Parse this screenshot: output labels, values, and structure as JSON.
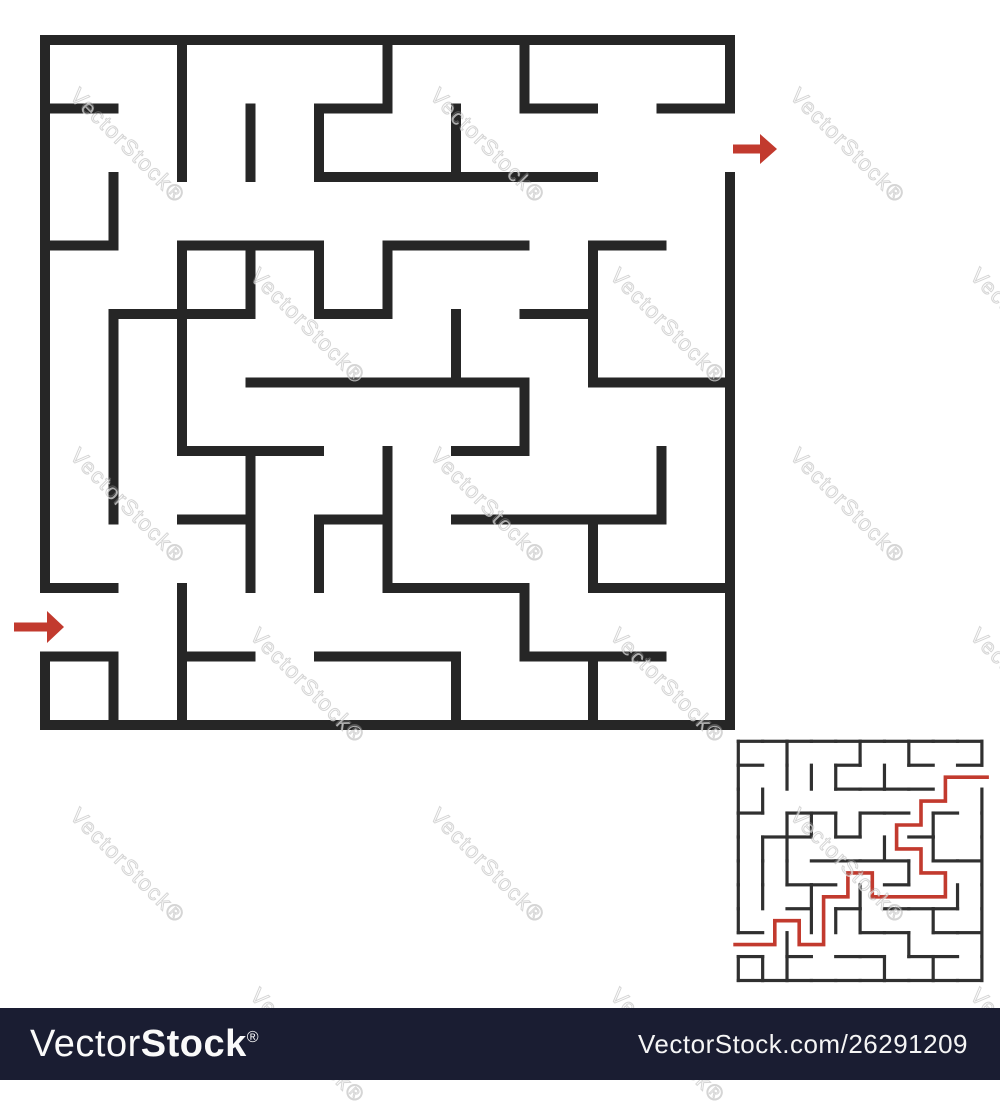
{
  "title": "Abstract square maze with entry and exit arrows and solution thumbnail",
  "watermark": {
    "text": "VectorStock",
    "reg_mark": "®",
    "angle_deg": 45,
    "anchors": [
      [
        83,
        83
      ],
      [
        443,
        83
      ],
      [
        803,
        83
      ],
      [
        263,
        263
      ],
      [
        623,
        263
      ],
      [
        983,
        263
      ],
      [
        83,
        443
      ],
      [
        443,
        443
      ],
      [
        803,
        443
      ],
      [
        263,
        623
      ],
      [
        623,
        623
      ],
      [
        983,
        623
      ],
      [
        83,
        803
      ],
      [
        443,
        803
      ],
      [
        803,
        803
      ],
      [
        263,
        983
      ],
      [
        623,
        983
      ],
      [
        983,
        983
      ]
    ]
  },
  "maze": {
    "rows": 10,
    "cols": 10,
    "wall_color_big": "#262626",
    "wall_color_small": "#303030",
    "accent_red": "#c23a2e",
    "big": {
      "x": 45,
      "y": 40,
      "cell": 68.5,
      "thickness": 10
    },
    "small": {
      "x": 738.3,
      "y": 741.3,
      "cell_w": 24.36,
      "cell_h": 23.92,
      "thickness": 3.2,
      "solution_width": 3.6
    },
    "h_walls": {
      "0": [
        0,
        1,
        2,
        3,
        4,
        5,
        6,
        7,
        8,
        9
      ],
      "1": [
        0,
        4,
        7,
        9
      ],
      "2": [
        4,
        5,
        6,
        7
      ],
      "3": [
        0,
        2,
        3,
        5,
        6,
        8
      ],
      "4": [
        1,
        2,
        4,
        7
      ],
      "5": [
        3,
        4,
        5,
        6,
        8,
        9
      ],
      "6": [
        2,
        3,
        6
      ],
      "7": [
        2,
        4,
        6,
        7,
        8
      ],
      "8": [
        0,
        5,
        6,
        8,
        9
      ],
      "9": [
        0,
        2,
        4,
        5,
        7,
        8
      ],
      "10": [
        0,
        1,
        2,
        3,
        4,
        5,
        6,
        7,
        8,
        9
      ]
    },
    "v_walls": {
      "0": [
        0,
        1,
        2,
        3,
        4,
        5,
        6,
        7,
        9
      ],
      "1": [
        2,
        4,
        5,
        6,
        9
      ],
      "2": [
        0,
        1,
        3,
        4,
        5,
        8,
        9
      ],
      "3": [
        1,
        3,
        6,
        7
      ],
      "4": [
        1,
        3,
        7
      ],
      "5": [
        0,
        3,
        6,
        7
      ],
      "6": [
        1,
        4,
        9
      ],
      "7": [
        0,
        5,
        8
      ],
      "8": [
        3,
        4,
        7,
        9
      ],
      "9": [
        6
      ],
      "10": [
        0,
        2,
        3,
        4,
        5,
        6,
        7,
        8,
        9
      ]
    },
    "entrance": {
      "side": "left",
      "row": 8
    },
    "exit": {
      "side": "right",
      "row": 1
    },
    "solution_cells": [
      [
        8,
        0
      ],
      [
        8,
        1
      ],
      [
        7,
        1
      ],
      [
        7,
        2
      ],
      [
        8,
        2
      ],
      [
        8,
        3
      ],
      [
        7,
        3
      ],
      [
        6,
        3
      ],
      [
        6,
        4
      ],
      [
        5,
        4
      ],
      [
        5,
        5
      ],
      [
        6,
        5
      ],
      [
        6,
        6
      ],
      [
        6,
        7
      ],
      [
        6,
        8
      ],
      [
        5,
        8
      ],
      [
        5,
        7
      ],
      [
        4,
        7
      ],
      [
        4,
        6
      ],
      [
        3,
        6
      ],
      [
        3,
        7
      ],
      [
        2,
        7
      ],
      [
        2,
        8
      ],
      [
        1,
        8
      ],
      [
        1,
        9
      ]
    ],
    "entrance_arrow": {
      "tip_x": 64,
      "tip_y": 627,
      "length": 50,
      "head_len": 17,
      "head_half": 16,
      "shaft_half": 4.5
    },
    "exit_arrow": {
      "tip_x": 777,
      "tip_y": 149,
      "length": 44,
      "head_len": 17,
      "head_half": 15,
      "shaft_half": 4.5
    }
  },
  "footer": {
    "bg": "#1a1d32",
    "logo_light": "Vector",
    "logo_bold": "Stock",
    "logo_reg": "®",
    "url": "VectorStock.com/26291209"
  }
}
